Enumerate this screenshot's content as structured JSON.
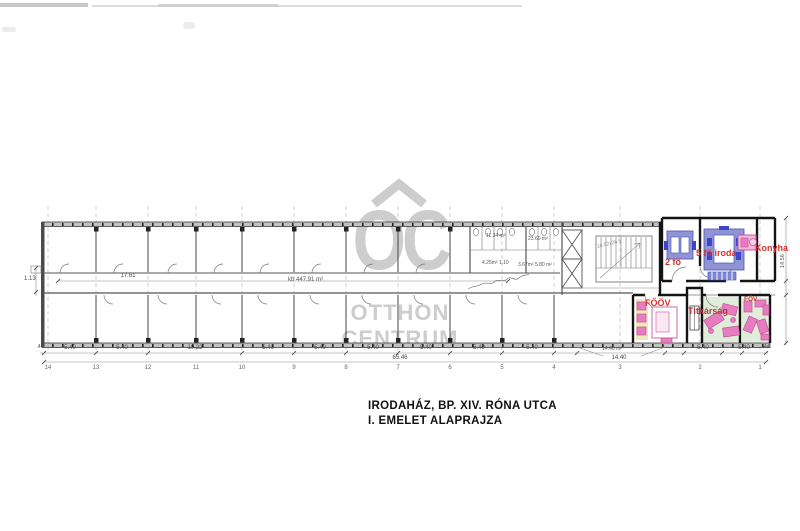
{
  "watermark": {
    "letters": "OC",
    "line1": "OTTHON",
    "line2": "CENTRUM"
  },
  "title": {
    "line1": "IRODAHÁZ, BP. XIV. RÓNA UTCA",
    "line2": "I. EMELET ALAPRAJZA"
  },
  "rooms": {
    "two_person": "2 fő",
    "five_person_office": "5 fő iroda",
    "kitchen": "Konyha",
    "executive": "FŐÖV",
    "secretariat": "Titkárság",
    "corner_office": "FŐV"
  },
  "annotations": {
    "corridor_area": "kb 447.91 m²",
    "corridor_length": "17.61",
    "left_offset": "1.13",
    "bay_area": "14.46 m²",
    "total_length": "65.46",
    "right_height": "14.56",
    "wc_area_1": "11.34 m²",
    "wc_area_2": "23.60 m²",
    "wc_area_3": "4.25m² 1.10",
    "wc_area_4": "3.67m² 5.80 m²",
    "stair_note": "10.52x26.5"
  },
  "dimensions": {
    "segments": [
      ".44",
      "5.40",
      "5.40",
      "10.22",
      "5.40",
      "5.40",
      "5.40",
      "5.40",
      "5.40",
      "5.40",
      "14.40",
      "5.40",
      "5.40",
      ".44"
    ]
  },
  "grid_numbers": [
    "14",
    "13",
    "12",
    "11",
    "10",
    "9",
    "8",
    "7",
    "6",
    "5",
    "4",
    "3",
    "2",
    "1"
  ],
  "colors": {
    "label_red": "#d6332f",
    "secretariat_red": "#b5383f",
    "furniture_purple": "#8f95d4",
    "furniture_blue": "#3c46c8",
    "furniture_pink": "#e87cc0",
    "furniture_pink_border": "#c2579e",
    "floor_green": "#e0edd8",
    "floor_yellow": "#efe9b8",
    "watermark_gray": "#c9c9c9"
  }
}
